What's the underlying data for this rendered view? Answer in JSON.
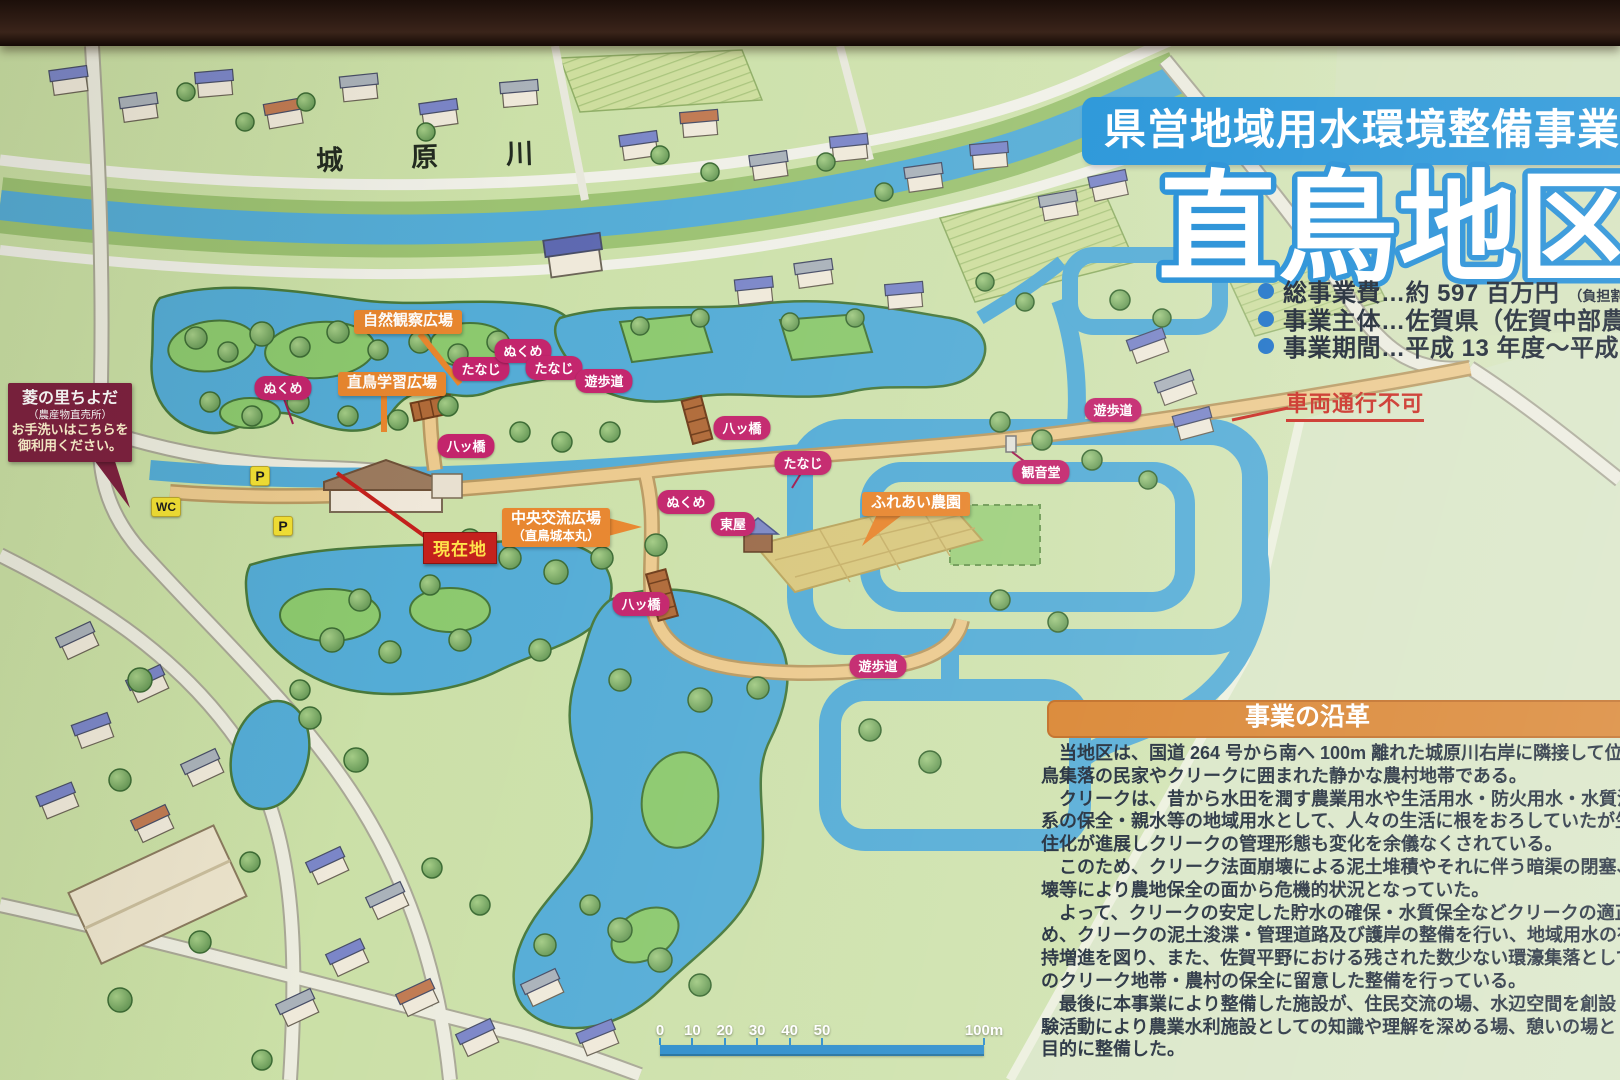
{
  "sign": {
    "program_title": "県営地域用水環境整備事業",
    "area_name": "直鳥地区",
    "facts": [
      {
        "text": "総事業費…約 597 百万円",
        "note": "（負担割合：国 50%、県 25"
      },
      {
        "text": "事業主体…佐賀県（佐賀中部農林事務所",
        "note": ""
      },
      {
        "text": "事業期間…平成 13 年度～平成 22 年度",
        "note": ""
      }
    ]
  },
  "map": {
    "river_name": "城原川",
    "info_callout": {
      "line1": "菱の里ちよだ",
      "line2": "（農産物直売所）",
      "line3": "お手洗いはこちらを",
      "line4": "御利用ください。"
    },
    "current_location": "現在地",
    "vehicle_notice": "車両通行不可",
    "toilet": "WC",
    "parking": "P",
    "area_callouts": [
      {
        "text": "自然観察広場"
      },
      {
        "text": "直鳥学習広場"
      },
      {
        "text": "中央交流広場",
        "sub": "（直鳥城本丸）"
      },
      {
        "text": "ふれあい農園"
      }
    ],
    "spot_labels": [
      {
        "text": "ぬくめ",
        "x": 283,
        "y": 388
      },
      {
        "text": "たなじ",
        "x": 481,
        "y": 369
      },
      {
        "text": "ぬくめ",
        "x": 523,
        "y": 351
      },
      {
        "text": "たなじ",
        "x": 554,
        "y": 368
      },
      {
        "text": "遊歩道",
        "x": 604,
        "y": 381
      },
      {
        "text": "八ッ橋",
        "x": 466,
        "y": 446
      },
      {
        "text": "八ッ橋",
        "x": 742,
        "y": 428
      },
      {
        "text": "たなじ",
        "x": 803,
        "y": 463
      },
      {
        "text": "ぬくめ",
        "x": 686,
        "y": 502
      },
      {
        "text": "東屋",
        "x": 733,
        "y": 524
      },
      {
        "text": "観音堂",
        "x": 1041,
        "y": 472
      },
      {
        "text": "遊歩道",
        "x": 1113,
        "y": 410
      },
      {
        "text": "八ッ橋",
        "x": 641,
        "y": 604
      },
      {
        "text": "遊歩道",
        "x": 878,
        "y": 666
      }
    ]
  },
  "history": {
    "title": "事業の沿革",
    "lines": [
      "　当地区は、国道 264 号から南へ 100m 離れた城原川右岸に隣接して位置し、その周囲",
      "鳥集落の民家やクリークに囲まれた静かな農村地帯である。",
      "　クリークは、昔から水田を潤す農業用水や生活用水・防火用水・水質浄化用水・景観や",
      "系の保全・親水等の地域用水として、人々の生活に根をおろしていたが生活様式の多様化",
      "住化が進展しクリークの管理形態も変化を余儀なくされている。",
      "　このため、クリーク法面崩壊による泥土堆積やそれに伴う暗渠の閉塞、さらに水田の法",
      "壊等により農地保全の面から危機的状況となっていた。",
      "　よって、クリークの安定した貯水の確保・水質保全などクリークの適正な保全管理を行",
      "め、クリークの泥土浚渫・管理道路及び護岸の整備を行い、地域用水の有する多面的機能",
      "持増進を図り、また、佐賀平野における残された数少ない環濠集落として昭和 30 年～40",
      "のクリーク地帯・農村の保全に留意した整備を行っている。",
      "　最後に本事業により整備した施設が、住民交流の場、水辺空間を創設しクリークを通し",
      "験活動により農業水利施設としての知識や理解を深める場、憩いの場として活用されるこ",
      "目的に整備した。"
    ]
  },
  "scale_bar": {
    "ticks": [
      "0",
      "10",
      "20",
      "30",
      "40",
      "50"
    ],
    "end": "100m"
  },
  "colors": {
    "banner_blue": "#2293d8",
    "pill_magenta": "#c3246c",
    "callout_orange": "#e8862e",
    "history_orange": "#d9832e",
    "maroon": "#7c1f3e",
    "alert_red": "#c92a20",
    "current_location_red": "#c4201c",
    "current_location_text": "#ffe34a",
    "water_blue": "#54acd6",
    "land_green": "#cfe0aa",
    "badge_yellow": "#f2e034"
  }
}
